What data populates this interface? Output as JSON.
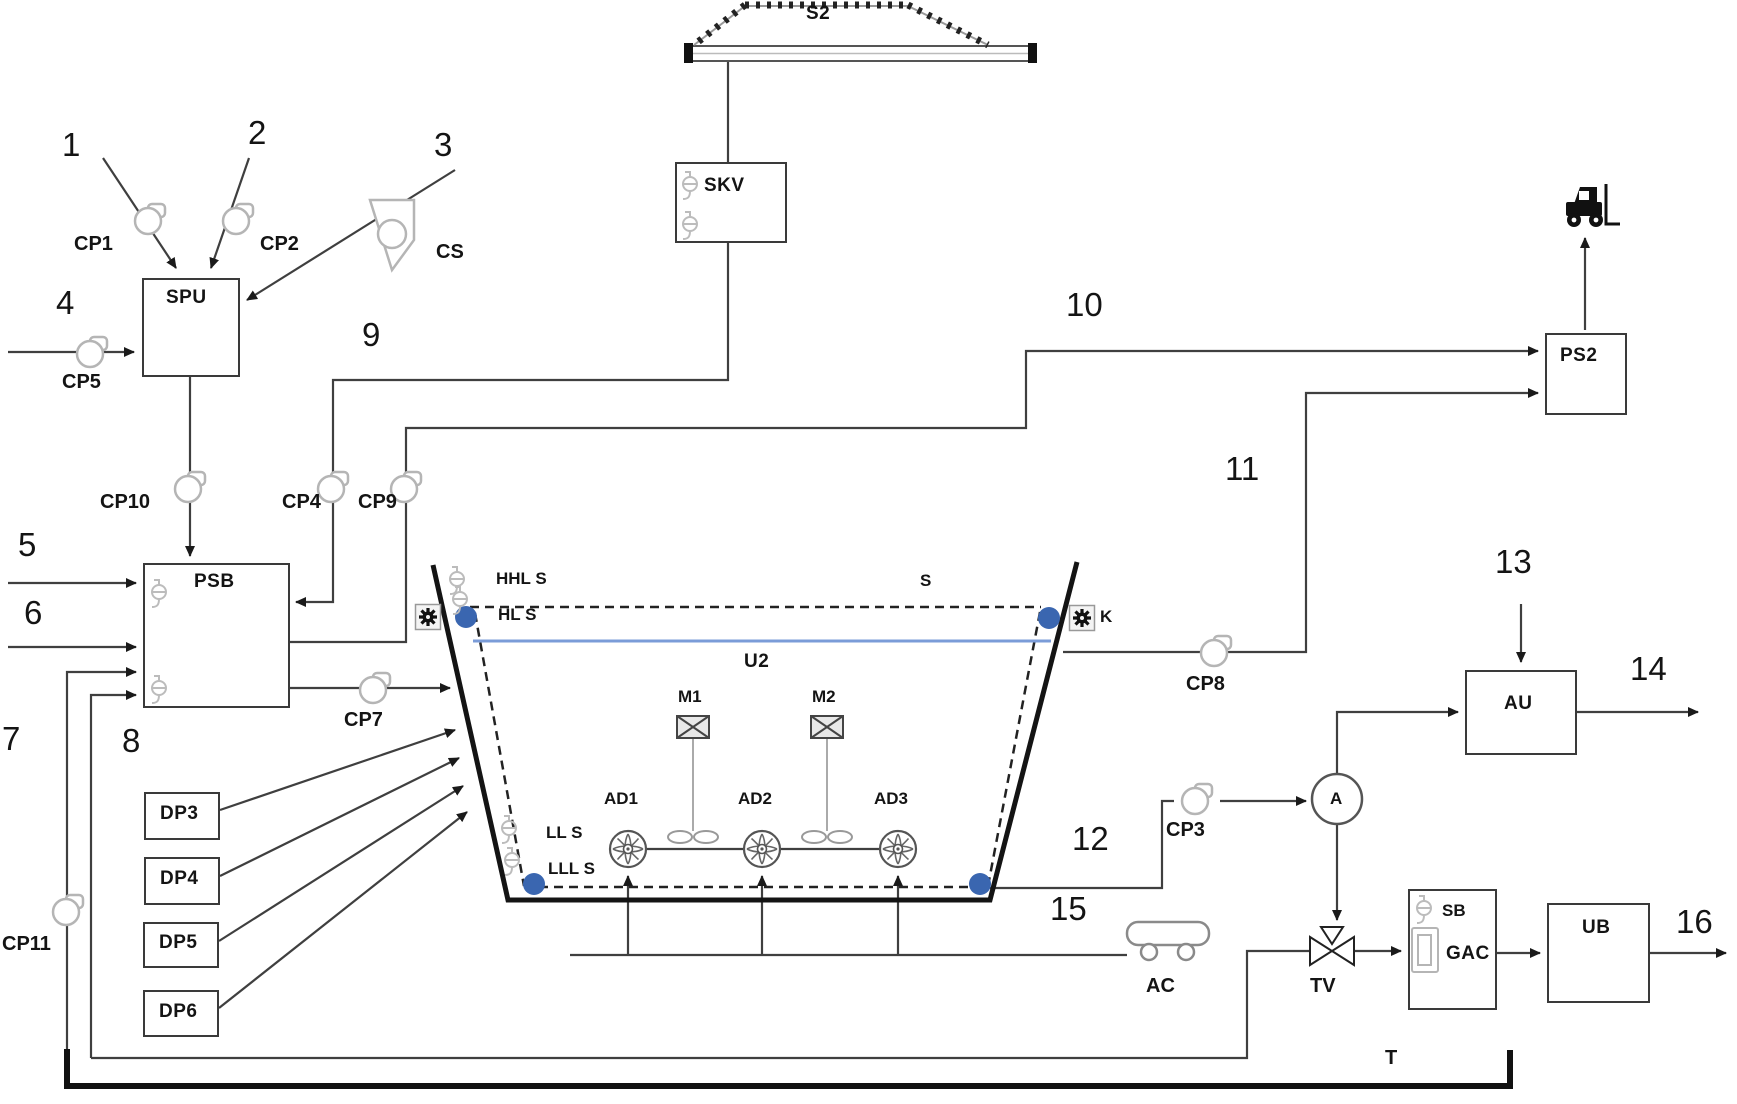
{
  "diagram_title": "Wastewater treatment process flow diagram",
  "colors": {
    "dot_blue": "#3a66b0",
    "water_blue": "#7b9cd8",
    "line_gray": "#3f3f3f",
    "wall_black": "#141414",
    "icon_gray": "#b5b5b5"
  },
  "labels": {
    "n1": "1",
    "n2": "2",
    "n3": "3",
    "n4": "4",
    "n5": "5",
    "n6": "6",
    "n7": "7",
    "n8": "8",
    "n9": "9",
    "n10": "10",
    "n11": "11",
    "n12": "12",
    "n13": "13",
    "n14": "14",
    "n15": "15",
    "n16": "16",
    "s2": "S2",
    "skv": "SKV",
    "cp1": "CP1",
    "cp2": "CP2",
    "cs": "CS",
    "cp5": "CP5",
    "spu": "SPU",
    "cp10": "CP10",
    "cp4": "CP4",
    "cp9": "CP9",
    "psb": "PSB",
    "cp7": "CP7",
    "cp11": "CP11",
    "dp3": "DP3",
    "dp4": "DP4",
    "dp5": "DP5",
    "dp6": "DP6",
    "hhls": "HHL S",
    "hls": "HL S",
    "lls": "LL S",
    "llls": "LLL S",
    "s": "S",
    "k": "K",
    "u2": "U2",
    "m1": "M1",
    "m2": "M2",
    "ad1": "AD1",
    "ad2": "AD2",
    "ad3": "AD3",
    "cp8": "CP8",
    "ps2": "PS2",
    "au": "AU",
    "analyzer": "A",
    "cp3": "CP3",
    "tv": "TV",
    "sb": "SB",
    "gac": "GAC",
    "ub": "UB",
    "ac": "AC",
    "t": "T"
  }
}
